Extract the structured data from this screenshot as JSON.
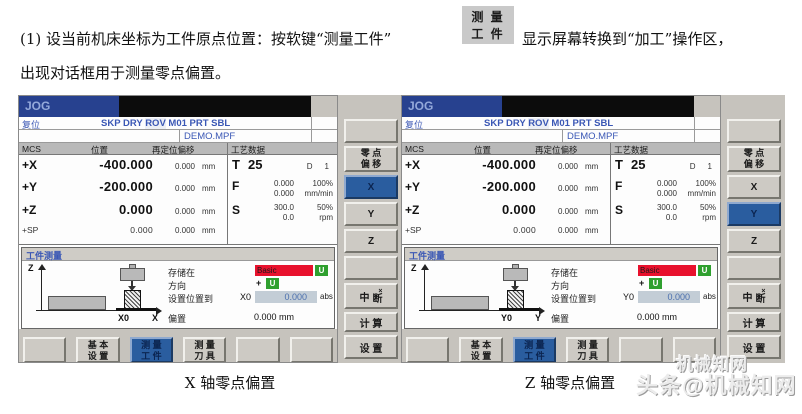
{
  "intro": {
    "line1_pre": "(1) 设当前机床坐标为工件原点位置：按软键“测量工件”",
    "button": {
      "line1": "测 量",
      "line2": "工 件"
    },
    "line1_post": "显示屏幕转换到“加工”操作区，",
    "line2": "出现对话框用于测量零点偏置。"
  },
  "captions": {
    "left": "X 轴零点偏置",
    "right": "Z 轴零点偏置"
  },
  "watermark": {
    "line1": "机械知网",
    "line2": "头条@机械知网"
  },
  "colors": {
    "accent_blue": "#2a5d9f",
    "title_blue": "#27418f",
    "basic_red": "#e8112d",
    "u_green": "#2fa02f"
  },
  "screens": [
    {
      "mode": "JOG",
      "status_reset": "复位",
      "flags_pre": "SKP DRY ",
      "flags_hl": "ROV",
      "flags_post": " M01 PRT SBL",
      "program": "DEMO.MPF",
      "table": {
        "headers": [
          "MCS",
          "位置",
          "再定位偏移",
          "工艺数据"
        ],
        "rows": [
          {
            "axis": "+X",
            "pos": "-400.000",
            "rep": "0.000",
            "unit": "mm"
          },
          {
            "axis": "+Y",
            "pos": "-200.000",
            "rep": "0.000",
            "unit": "mm"
          },
          {
            "axis": "+Z",
            "pos": "0.000",
            "rep": "0.000",
            "unit": "mm"
          },
          {
            "axis": "+SP",
            "pos": "0.000",
            "rep": "0.000",
            "unit": "mm"
          }
        ],
        "tool": {
          "t": "T",
          "t_val": "25",
          "d": "D",
          "d_val": "1",
          "f": "F",
          "f1": "0.000",
          "f_pct": "100%",
          "f2": "0.000",
          "f_unit": "mm/min",
          "s": "S",
          "s1": "300.0",
          "s_pct": "50%",
          "s2": "0.0",
          "s_unit": "rpm"
        }
      },
      "dialog": {
        "title": "工件测量",
        "stored_label": "存储在",
        "stored_value": "Basic",
        "stored_unit": "U",
        "dir_label": "方向",
        "dir_value": "+",
        "dir_unit": "U",
        "setpos_label": "设置位置到",
        "setpos_axis": "X0",
        "setpos_value": "0.000",
        "setpos_suffix": "abs",
        "offset_label": "偏置",
        "offset_value": "0.000 mm",
        "diagram": {
          "vaxis": "Z",
          "origin_label": "X0",
          "haxis": "X"
        }
      },
      "vkeys": [
        {
          "label": ""
        },
        {
          "line1": "零 点",
          "line2": "偏 移"
        },
        {
          "label": "X"
        },
        {
          "label": "Y"
        },
        {
          "label": "Z"
        },
        {
          "label": ""
        },
        {
          "main": "中",
          "sup": "×",
          "sub": "断"
        },
        {
          "label": "计 算"
        },
        {
          "label": "设 置"
        }
      ],
      "hkeys": [
        {
          "line1": "",
          "line2": ""
        },
        {
          "line1": "基 本",
          "line2": "设 置"
        },
        {
          "line1": "测 量",
          "line2": "工 件"
        },
        {
          "line1": "测 量",
          "line2": "刀 具"
        },
        {
          "line1": "",
          "line2": ""
        },
        {
          "line1": "",
          "line2": ""
        }
      ]
    },
    {
      "mode": "JOG",
      "status_reset": "复位",
      "flags_pre": "SKP DRY ",
      "flags_hl": "ROV",
      "flags_post": " M01 PRT SBL",
      "program": "DEMO.MPF",
      "table": {
        "headers": [
          "MCS",
          "位置",
          "再定位偏移",
          "工艺数据"
        ],
        "rows": [
          {
            "axis": "+X",
            "pos": "-400.000",
            "rep": "0.000",
            "unit": "mm"
          },
          {
            "axis": "+Y",
            "pos": "-200.000",
            "rep": "0.000",
            "unit": "mm"
          },
          {
            "axis": "+Z",
            "pos": "0.000",
            "rep": "0.000",
            "unit": "mm"
          },
          {
            "axis": "+SP",
            "pos": "0.000",
            "rep": "0.000",
            "unit": "mm"
          }
        ],
        "tool": {
          "t": "T",
          "t_val": "25",
          "d": "D",
          "d_val": "1",
          "f": "F",
          "f1": "0.000",
          "f_pct": "100%",
          "f2": "0.000",
          "f_unit": "mm/min",
          "s": "S",
          "s1": "300.0",
          "s_pct": "50%",
          "s2": "0.0",
          "s_unit": "rpm"
        }
      },
      "dialog": {
        "title": "工件测量",
        "stored_label": "存储在",
        "stored_value": "Basic",
        "stored_unit": "U",
        "dir_label": "方向",
        "dir_value": "+",
        "dir_unit": "U",
        "setpos_label": "设置位置到",
        "setpos_axis": "Y0",
        "setpos_value": "0.000",
        "setpos_suffix": "abs",
        "offset_label": "偏置",
        "offset_value": "0.000 mm",
        "diagram": {
          "vaxis": "Z",
          "origin_label": "Y0",
          "haxis": "Y"
        }
      },
      "vkeys": [
        {
          "label": ""
        },
        {
          "line1": "零 点",
          "line2": "偏 移"
        },
        {
          "label": "X"
        },
        {
          "label": "Y"
        },
        {
          "label": "Z"
        },
        {
          "label": ""
        },
        {
          "main": "中",
          "sup": "×",
          "sub": "断"
        },
        {
          "label": "计 算"
        },
        {
          "label": "设 置"
        }
      ],
      "hkeys": [
        {
          "line1": "",
          "line2": ""
        },
        {
          "line1": "基 本",
          "line2": "设 置"
        },
        {
          "line1": "测 量",
          "line2": "工 件"
        },
        {
          "line1": "测 量",
          "line2": "刀 具"
        },
        {
          "line1": "",
          "line2": ""
        },
        {
          "line1": "",
          "line2": ""
        }
      ]
    }
  ]
}
